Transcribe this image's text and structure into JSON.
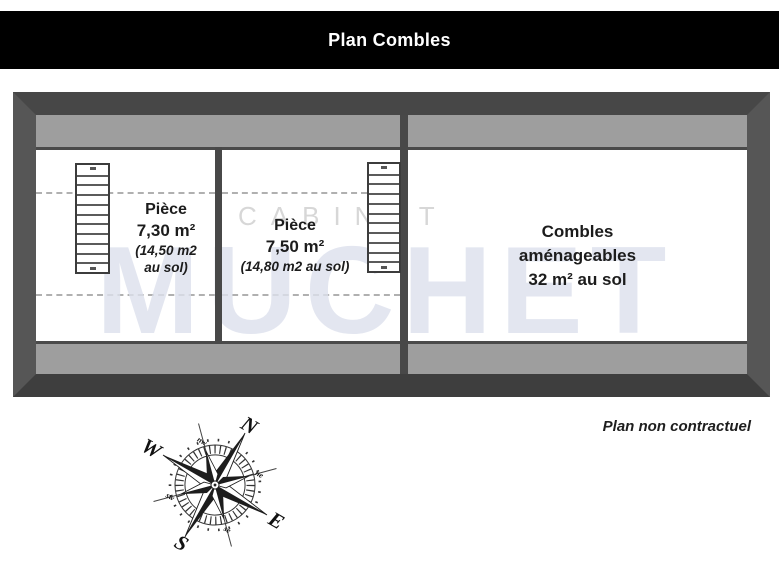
{
  "title_bar": {
    "title": "Plan Combles"
  },
  "plan": {
    "rooms": [
      {
        "id": "piece-1",
        "main_lines": [
          "Pièce",
          "7,30 m²"
        ],
        "sub_lines": [
          "(14,50 m2",
          "au sol)"
        ]
      },
      {
        "id": "piece-2",
        "main_lines": [
          "Pièce",
          "7,50 m²"
        ],
        "sub_lines": [
          "(14,80 m2 au sol)"
        ]
      },
      {
        "id": "combles",
        "main_lines": [
          "Combles",
          "aménageables",
          "32 m² au sol"
        ],
        "sub_lines": []
      }
    ],
    "stairs": [
      {
        "steps": 10
      },
      {
        "steps": 10
      }
    ]
  },
  "watermark": {
    "line1": "CABINET",
    "line2": "MUCHET"
  },
  "footer": {
    "disclaimer": "Plan non contractuel"
  },
  "compass": {
    "n": "N",
    "e": "E",
    "s": "S",
    "w": "W",
    "ne": "ne",
    "se": "se",
    "sw": "sw",
    "nw": "nw",
    "rotation_deg": 30
  },
  "colors": {
    "title_bg": "#000000",
    "title_text": "#ffffff",
    "wall": "#4a4a4a",
    "band": "#9e9e9e",
    "room": "#ffffff",
    "text": "#1c1c1c",
    "watermark": "#dde1ed"
  }
}
